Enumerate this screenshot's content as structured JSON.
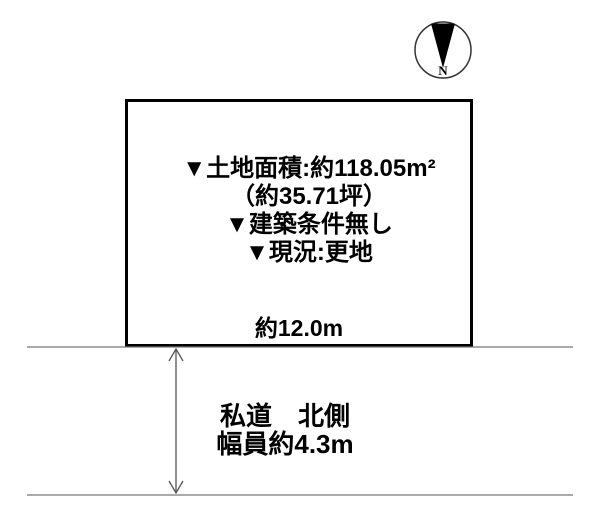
{
  "compass": {
    "north_label": "N"
  },
  "plot": {
    "details": [
      "▼土地面積:約118.05m²",
      "（約35.71坪）",
      "▼建築条件無し",
      "▼現況:更地"
    ],
    "frontage_label": "約12.0m"
  },
  "road": {
    "name_label": "私道　北側",
    "width_label": "幅員約4.3m"
  },
  "colors": {
    "ink": "#111111",
    "thin_line": "#777777",
    "arrow": "#555555"
  }
}
